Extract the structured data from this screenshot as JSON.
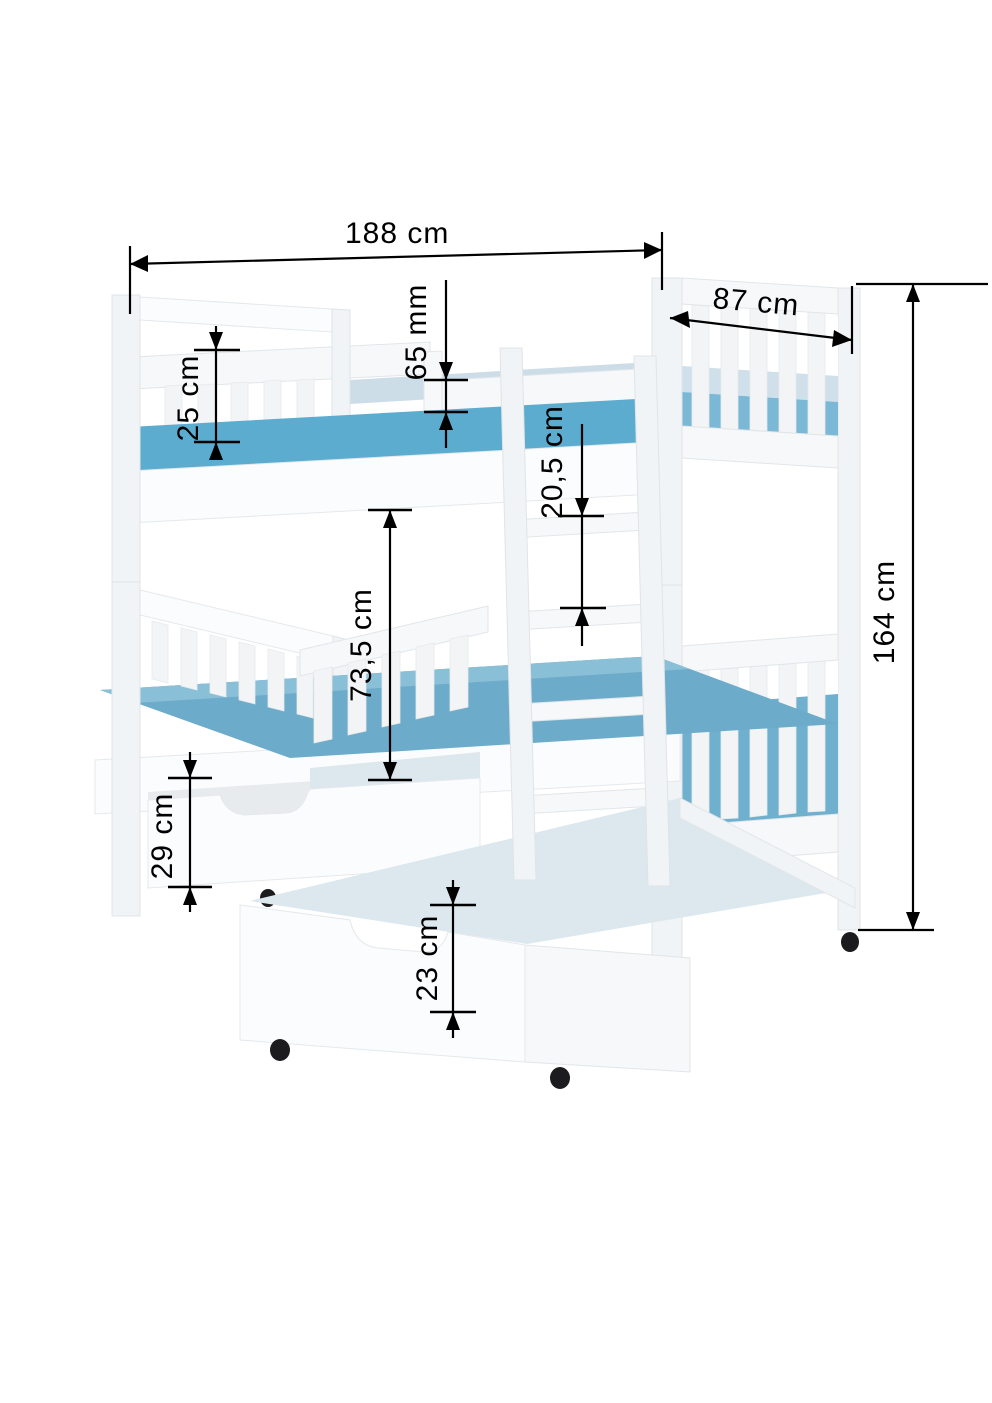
{
  "diagram": {
    "type": "furniture-dimension-drawing",
    "subject": "bunk-bed-with-storage-drawers",
    "dimensions": {
      "overall_length": "188 cm",
      "overall_depth": "87 cm",
      "guard_board_thickness": "65 mm",
      "upper_guard_height": "25 cm",
      "ladder_rung_spacing": "20,5 cm",
      "bunk_clearance": "73,5 cm",
      "overall_height": "164 cm",
      "under_bed_drawer_height": "29 cm",
      "pullout_drawer_depth": "23 cm"
    },
    "colors": {
      "frame_white": "#f6f8f9",
      "mattress_blue": "#5cacd0",
      "mattress_blue_lower": "#6cabc9",
      "mattress_pale_top": "#ccdde8",
      "drawer_interior": "#dce8ee",
      "caster_black": "#1c1c1e",
      "dimension_line": "#000000"
    }
  }
}
